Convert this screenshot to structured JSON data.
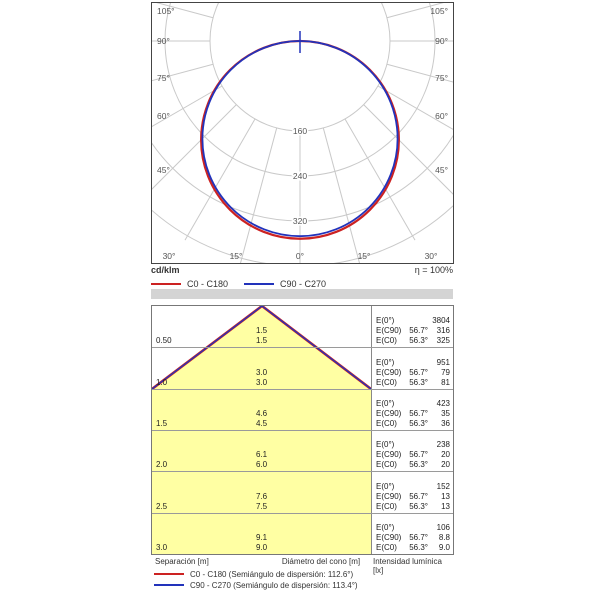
{
  "polar": {
    "unit_label": "cd/klm",
    "efficiency_label": "η = 100%",
    "legend": [
      {
        "label": "C0 - C180",
        "color": "#cc2222"
      },
      {
        "label": "C90 - C270",
        "color": "#2233bb"
      }
    ],
    "side_angle_labels": [
      "105°",
      "90°",
      "75°",
      "60°",
      "45°"
    ],
    "bottom_angle_labels": [
      "30°",
      "15°",
      "0°",
      "15°",
      "30°"
    ],
    "radial_tick_labels": [
      "160",
      "240",
      "320"
    ]
  },
  "cone": {
    "fill_color": "#ffffa3",
    "e0_label": "E(0°)",
    "ec90_label": "E(C90)",
    "ec0_label": "E(C0)",
    "c90_angle": "56.7°",
    "c0_angle": "56.3°",
    "rows": [
      {
        "sep": "0.50",
        "dia_c90": "1.5",
        "dia_c0": "1.5",
        "e0": "3804",
        "ec90": "316",
        "ec0": "325"
      },
      {
        "sep": "1.0",
        "dia_c90": "3.0",
        "dia_c0": "3.0",
        "e0": "951",
        "ec90": "79",
        "ec0": "81"
      },
      {
        "sep": "1.5",
        "dia_c90": "4.6",
        "dia_c0": "4.5",
        "e0": "423",
        "ec90": "35",
        "ec0": "36"
      },
      {
        "sep": "2.0",
        "dia_c90": "6.1",
        "dia_c0": "6.0",
        "e0": "238",
        "ec90": "20",
        "ec0": "20"
      },
      {
        "sep": "2.5",
        "dia_c90": "7.6",
        "dia_c0": "7.5",
        "e0": "152",
        "ec90": "13",
        "ec0": "13"
      },
      {
        "sep": "3.0",
        "dia_c90": "9.1",
        "dia_c0": "9.0",
        "e0": "106",
        "ec90": "8.8",
        "ec0": "9.0"
      }
    ],
    "footer": {
      "separation": "Separación [m]",
      "cone_diameter": "Diámetro del cono [m]",
      "intensity": "Intensidad lumínica [lx]"
    },
    "legend": [
      {
        "label": "C0 - C180 (Semiángulo de dispersión: 112.6°)",
        "color": "#cc2222"
      },
      {
        "label": "C90 - C270 (Semiángulo de dispersión: 113.4°)",
        "color": "#2233bb"
      }
    ]
  },
  "chart_data": [
    {
      "type": "line",
      "title": "Polar luminous intensity distribution",
      "polar": true,
      "unit": "cd/klm",
      "efficiency": "η = 100%",
      "angle_ticks_deg": [
        0,
        15,
        30,
        45,
        60,
        75,
        90,
        105
      ],
      "radial_ticks": [
        160,
        240,
        320
      ],
      "radial_rings": [
        160,
        240,
        320,
        400
      ],
      "x": [
        0,
        15,
        30,
        45,
        60,
        75,
        90
      ],
      "series": [
        {
          "name": "C0 - C180",
          "color": "#cc2222",
          "values": [
            348,
            336,
            301,
            246,
            174,
            90,
            0
          ]
        },
        {
          "name": "C90 - C270",
          "color": "#2233bb",
          "values": [
            347,
            335,
            300,
            245,
            173,
            90,
            0
          ]
        }
      ],
      "legend_position": "bottom-left"
    },
    {
      "type": "table",
      "title": "Cone diagram (Diagrama de conos)",
      "columns": [
        "Separación [m]",
        "Diámetro del cono C90 [m]",
        "Diámetro del cono C0 [m]",
        "E(0°) [lx]",
        "E(C90) 56.7° [lx]",
        "E(C0) 56.3° [lx]"
      ],
      "rows": [
        [
          "0.50",
          "1.5",
          "1.5",
          "3804",
          "316",
          "325"
        ],
        [
          "1.0",
          "3.0",
          "3.0",
          "951",
          "79",
          "81"
        ],
        [
          "1.5",
          "4.6",
          "4.5",
          "423",
          "35",
          "36"
        ],
        [
          "2.0",
          "6.1",
          "6.0",
          "238",
          "20",
          "20"
        ],
        [
          "2.5",
          "7.6",
          "7.5",
          "152",
          "13",
          "13"
        ],
        [
          "3.0",
          "9.1",
          "9.0",
          "106",
          "8.8",
          "9.0"
        ]
      ]
    }
  ]
}
